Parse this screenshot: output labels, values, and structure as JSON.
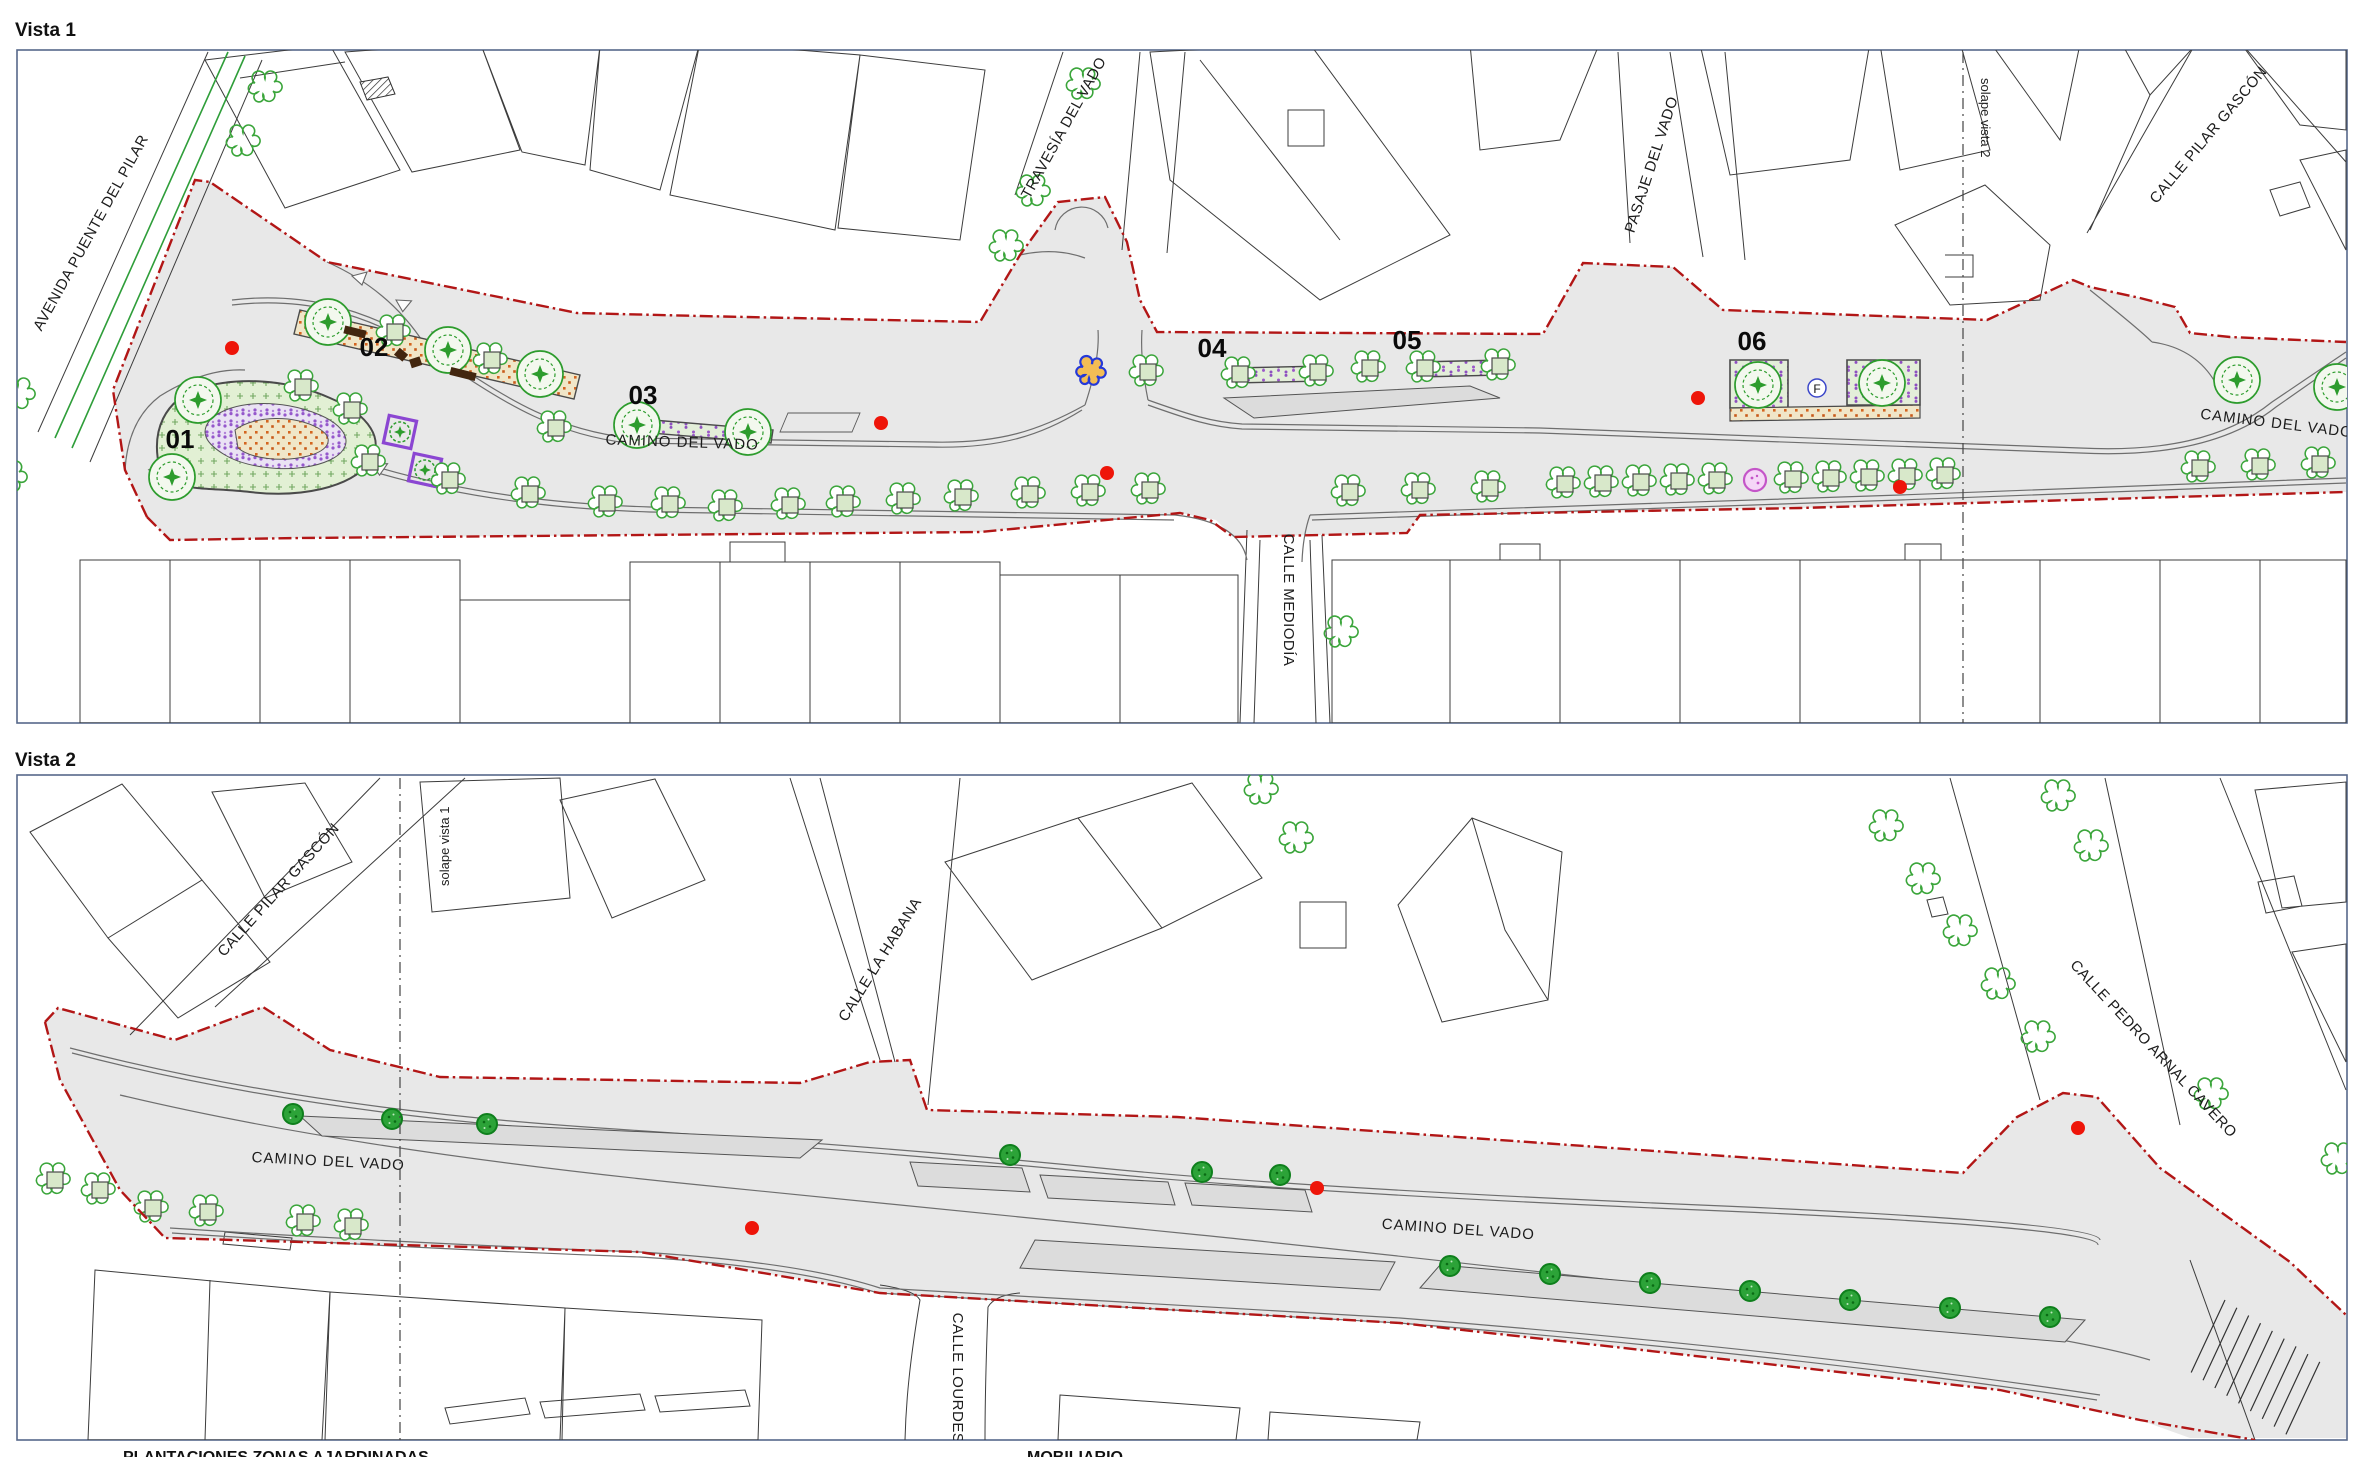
{
  "document": {
    "type": "urban-plan-drawing",
    "background": "#ffffff"
  },
  "colors": {
    "frame": "#56688a",
    "corridor_fill": "#e8e8e8",
    "median_fill": "#dcdcdc",
    "boundary_red": "#b21616",
    "red_dot": "#ee1509",
    "tree_green": "#3aa53a",
    "new_tree_green": "#2ca338",
    "violet_accent": "#8b46d2",
    "bench_brown": "#43260f",
    "orange_planting": "#d4651f"
  },
  "vista1": {
    "title": "Vista 1",
    "overlap_label": "solape vista 2",
    "fountain_label": "F",
    "streets": {
      "avenida": "AVENIDA PUENTE DEL PILAR",
      "travesia": "TRAVESÍA DEL VADO",
      "camino_left": "CAMINO DEL VADO",
      "mediodia": "CALLE MEDIODÍA",
      "pasaje": "PASAJE DEL VADO",
      "pilar_gascon": "CALLE PILAR GASCÓN",
      "camino_right": "CAMINO DEL VADO"
    },
    "zones": {
      "z1": "01",
      "z2": "02",
      "z3": "03",
      "z4": "04",
      "z5": "05",
      "z6": "06"
    }
  },
  "vista2": {
    "title": "Vista 2",
    "overlap_label": "solape vista 1",
    "streets": {
      "pilar_gascon": "CALLE PILAR GASCÓN",
      "la_habana": "CALLE LA HABANA",
      "camino_left": "CAMINO DEL VADO",
      "lourdes": "CALLE LOURDES",
      "camino_right": "CAMINO DEL VADO",
      "pedro_arnal": "CALLE PEDRO ARNAL CAVERO"
    }
  },
  "legend": {
    "plantings_title": "PLANTACIONES ZONAS AJARDINADAS",
    "furniture_title": "MOBILIARIO"
  }
}
